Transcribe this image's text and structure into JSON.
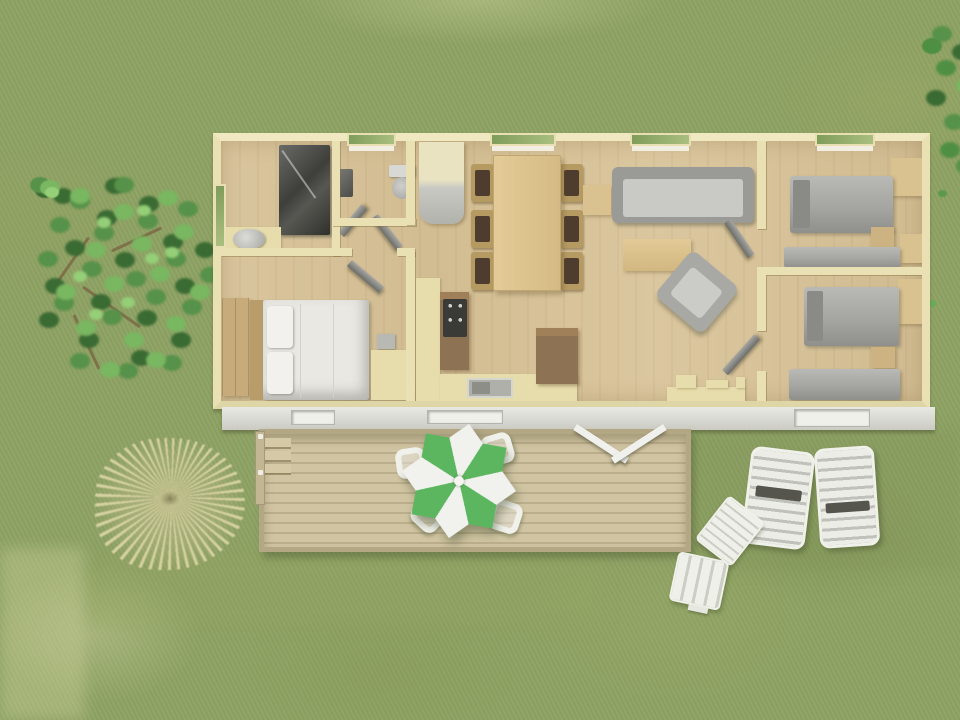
{
  "scene": {
    "kind": "aerial-3d-floor-plan-render",
    "building": "mobile-home",
    "rooms": [
      {
        "name": "bathroom",
        "fixtures": [
          "shower",
          "washbasin"
        ]
      },
      {
        "name": "wc",
        "fixtures": [
          "toilet",
          "small-sink"
        ]
      },
      {
        "name": "hallway",
        "fixtures": [
          "open-doors"
        ]
      },
      {
        "name": "master-bedroom",
        "fixtures": [
          "double-bed",
          "wardrobe",
          "dresser",
          "nightstand"
        ]
      },
      {
        "name": "kitchen",
        "fixtures": [
          "hob",
          "sink",
          "counter",
          "fridge",
          "tall-unit"
        ]
      },
      {
        "name": "dining-area",
        "fixtures": [
          "dining-table",
          "six-chairs"
        ]
      },
      {
        "name": "living-area",
        "fixtures": [
          "sofa",
          "coffee-table",
          "side-table",
          "armchair"
        ]
      },
      {
        "name": "twin-bedroom-top",
        "fixtures": [
          "single-bed",
          "single-bed",
          "wardrobe",
          "nightstand"
        ]
      },
      {
        "name": "twin-bedroom-bottom",
        "fixtures": [
          "single-bed",
          "single-bed",
          "wardrobe",
          "nightstand"
        ]
      }
    ],
    "outdoor": [
      "wood-deck-terrace",
      "deck-steps",
      "parasol-table-set",
      "four-deck-chairs",
      "sun-lounger-1",
      "sun-lounger-2",
      "folded-deck-chair",
      "garden-stool",
      "tree",
      "right-edge-bush",
      "ornamental-dried-grass"
    ],
    "window_count_front": 4,
    "window_count_rear": 3,
    "entrance": "double-french-doors-to-deck"
  },
  "colors": {
    "grass": "#8ea264",
    "grass_light": "#a9b478",
    "grass_dark": "#79894e",
    "wall": "#e9e1b4",
    "floor_wood": "#d6c098",
    "wood_furniture": "#d9c28f",
    "wood_dark": "#8d7254",
    "facade": "#d9d9d3",
    "deck": "#cbbf9e",
    "deck_line": "#b3a784",
    "gray_furniture": "#a2a29e",
    "gray_dark": "#4a4a46",
    "bed_white": "#e9e8e3",
    "parasol_green": "#5cb660",
    "parasol_white": "#f1f1ed",
    "lounger_white": "#ecede7",
    "tree_green": "#57924a",
    "tree_green_dark": "#3a6b33",
    "tree_green_light": "#79b761",
    "dried_grass": "#d6d1a2"
  }
}
